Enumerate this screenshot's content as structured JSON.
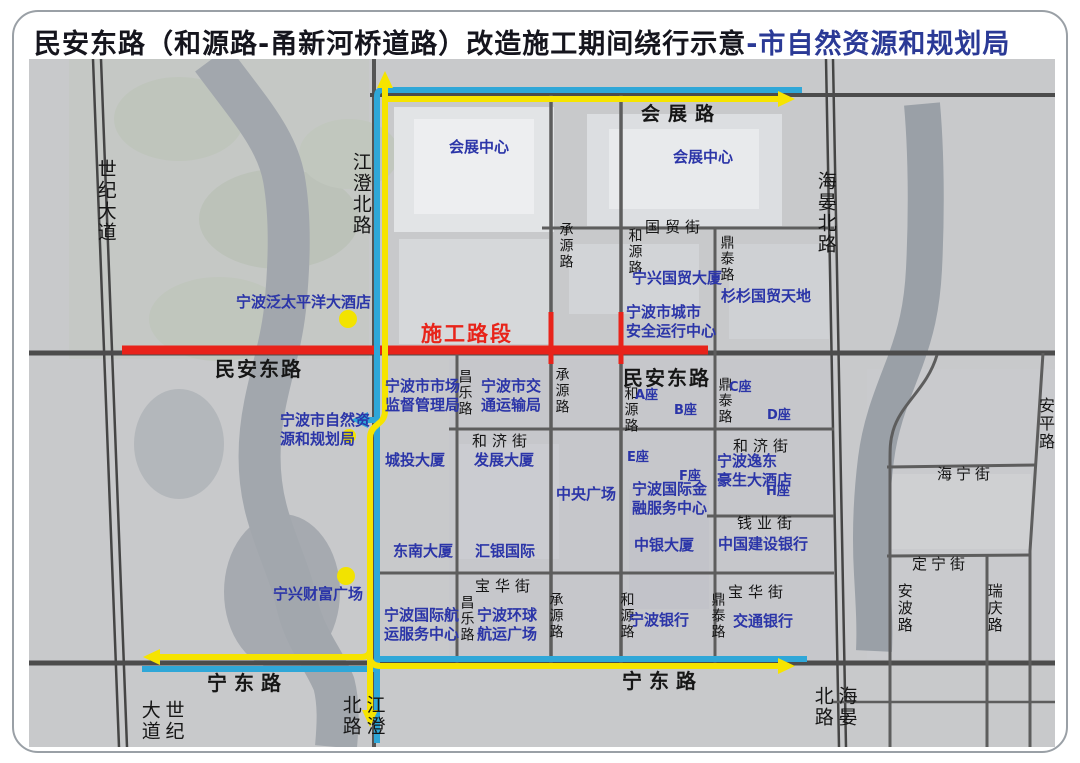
{
  "title": {
    "main": "民安东路（和源路-甬新河桥道路）改造施工期间绕行示意",
    "suffix": "-市自然资源和规划局"
  },
  "construction": {
    "label": "施工路段"
  },
  "colors": {
    "construction_red": "#e8231a",
    "detour_yellow": "#f6e400",
    "detour_blue": "#2fa7d8",
    "title_accent": "#2b3a96",
    "building_label_blue": "#2b35a8"
  },
  "map": {
    "roads": {
      "shiji": "世纪大道",
      "jiangcheng": "江澄北路",
      "haiyan": "海晏北路",
      "huizhan": "会展路",
      "minan": "民安东路",
      "ningdong": "宁东路",
      "guomao": "国贸街",
      "heji": "和济街",
      "qianye": "钱业街",
      "baohua": "宝华街",
      "changle": "昌乐路",
      "chengyuan": "承源路",
      "heyuan": "和源路",
      "dingtai": "鼎泰路",
      "haining": "海宁街",
      "dingning": "定宁街",
      "anping": "安平路",
      "anbo": "安波路",
      "ruiqing": "瑞庆路"
    },
    "buildings": {
      "huizhan_center": "会展中心",
      "pan_pacific": "宁波泛太平洋大酒店",
      "ningxing_guomao": "宁兴国贸大厦",
      "shanshan": "杉杉国贸天地",
      "city_safety": "宁波市城市\n安全运行中心",
      "market_bureau": "宁波市市场\n监督管理局",
      "transport_bureau": "宁波市交\n通运输局",
      "planning_bureau": "宁波市自然资\n源和规划局",
      "chengtou": "城投大厦",
      "fazhan": "发展大厦",
      "zhongyang": "中央广场",
      "block_a": "A座",
      "block_b": "B座",
      "block_c": "C座",
      "block_d": "D座",
      "block_e": "E座",
      "block_f": "F座",
      "block_h": "H座",
      "finance_center": "宁波国际金\n融服务中心",
      "yidong_hotel": "宁波逸东\n豪生大酒店",
      "zhongyin": "中银大厦",
      "ccb": "中国建设银行",
      "dongnan": "东南大厦",
      "huiyin": "汇银国际",
      "ningxing_fortune": "宁兴财富广场",
      "shipping_center": "宁波国际航\n运服务中心",
      "global_shipping": "宁波环球\n航运广场",
      "bank_ningbo": "宁波银行",
      "bocom": "交通银行"
    }
  }
}
